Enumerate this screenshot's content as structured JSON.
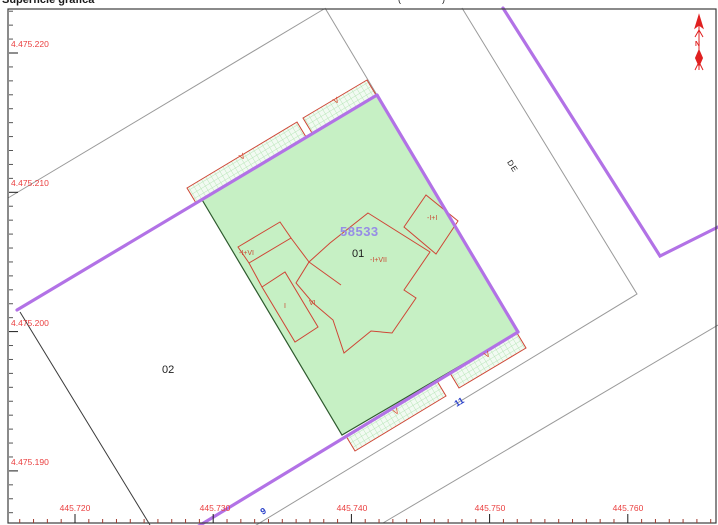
{
  "header": {
    "left_fragment": "Superficie gráfica",
    "mid_fragment": "(···· ··· ·····)",
    "right_fragment": "· ···· ··· ·· ····· ··· ·······"
  },
  "map": {
    "parcel_number": "58533",
    "parcel_sub": "01",
    "neighbor_parcel": "02",
    "street_name_fragment": "DE",
    "house_number_right": "11",
    "house_number_bottom": "9",
    "north_label": "N",
    "construction_labels": {
      "left_strip": "-I+VI",
      "main": "-I+VII",
      "upper_right": "-I+I",
      "left_block": "I",
      "mid_block": "VI",
      "overhang": "V"
    }
  },
  "axes": {
    "y_labels": [
      {
        "text": "4.475.220",
        "px": 53
      },
      {
        "text": "4.475.210",
        "px": 192
      },
      {
        "text": "4.475.200",
        "px": 332
      },
      {
        "text": "4.475.190",
        "px": 471
      }
    ],
    "x_labels": [
      {
        "text": "445.720",
        "px": 75
      },
      {
        "text": "445.730",
        "px": 215
      },
      {
        "text": "445.740",
        "px": 352
      },
      {
        "text": "445.750",
        "px": 490
      },
      {
        "text": "445.760",
        "px": 628
      }
    ],
    "minor_step_x": 13.82,
    "minor_step_y": 13.93
  },
  "colors": {
    "parcel_fill": "#c6f0c4",
    "boundary_purple": "#b272e6",
    "construction_red": "#cf4636",
    "axis_red": "#ea4040",
    "street_blue": "#2940c9",
    "parcel_number_violet": "#968ce6",
    "line_gray": "#9a9a9a",
    "frame": "#3c3c3c",
    "north_red": "#e02020"
  }
}
